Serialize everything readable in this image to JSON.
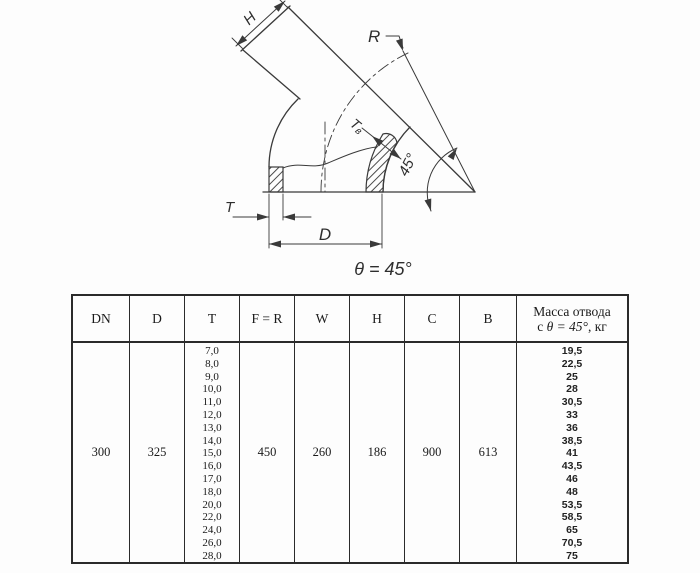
{
  "drawing": {
    "labels": {
      "h": "H",
      "r": "R",
      "tb_main": "Т",
      "tb_sub": "в",
      "angle": "45°",
      "t": "T",
      "d": "D",
      "theta": "θ = 45°"
    }
  },
  "table": {
    "headers": {
      "dn": "DN",
      "d": "D",
      "t": "T",
      "fr": "F = R",
      "w": "W",
      "h": "H",
      "c": "C",
      "b": "B"
    },
    "mass_header": {
      "line1": "Масса отвода",
      "line2_parts": [
        "с ",
        "θ = 45°",
        ", кг"
      ]
    },
    "values": {
      "dn": "300",
      "d": "325",
      "fr": "450",
      "w": "260",
      "h": "186",
      "c": "900",
      "b": "613"
    },
    "t_values": [
      "7,0",
      "8,0",
      "9,0",
      "10,0",
      "11,0",
      "12,0",
      "13,0",
      "14,0",
      "15,0",
      "16,0",
      "17,0",
      "18,0",
      "20,0",
      "22,0",
      "24,0",
      "26,0",
      "28,0"
    ],
    "mass_values": [
      "19,5",
      "22,5",
      "25",
      "28",
      "30,5",
      "33",
      "36",
      "38,5",
      "41",
      "43,5",
      "46",
      "48",
      "53,5",
      "58,5",
      "65",
      "70,5",
      "75"
    ]
  },
  "colors": {
    "line": "#3a3a3a",
    "table_border": "#2b2b2b",
    "background": "#fdfdfd"
  }
}
